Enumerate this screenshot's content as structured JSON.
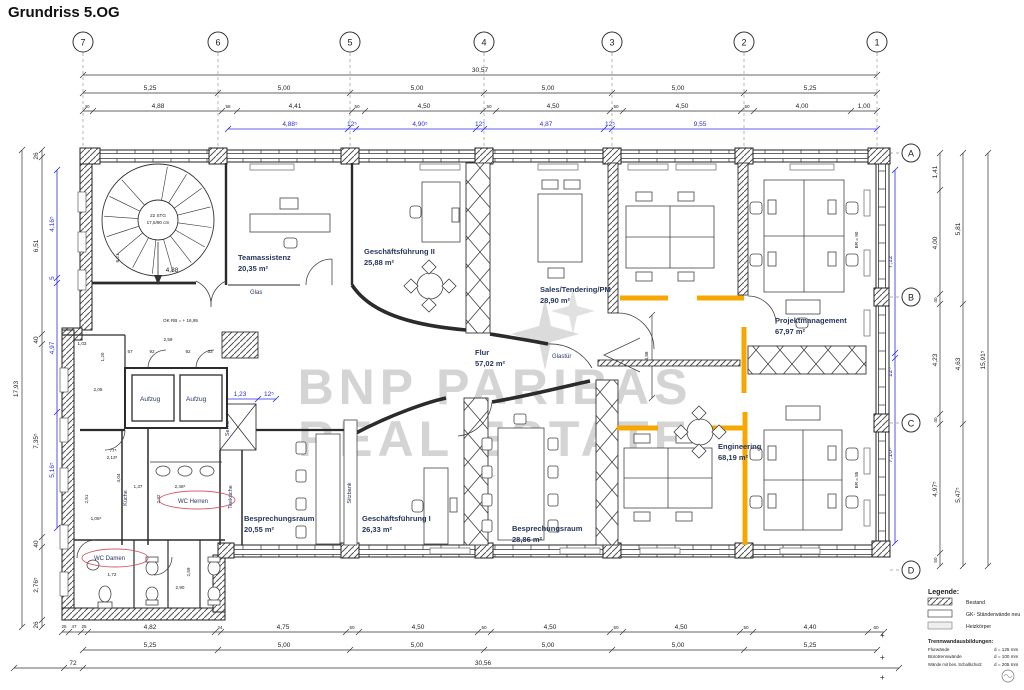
{
  "title": "Grundriss 5.OG",
  "grid": {
    "columns": [
      "7",
      "6",
      "5",
      "4",
      "3",
      "2",
      "1"
    ],
    "rows": [
      "A",
      "B",
      "C",
      "D"
    ]
  },
  "dims": {
    "top_total": "30,57",
    "top_bays": [
      "5,25",
      "5,00",
      "5,00",
      "5,00",
      "5,00",
      "5,25"
    ],
    "top_detail": [
      "40",
      "4,88",
      "58",
      "4,41",
      "50",
      "4,50",
      "50",
      "4,50",
      "50",
      "4,50",
      "50",
      "4,00",
      "1,00"
    ],
    "top_blue": [
      "4,88⁵",
      "12⁵",
      "4,90⁵",
      "12⁵",
      "4,87",
      "12⁵",
      "9,55"
    ],
    "left_total": "17,93",
    "left_chain": [
      "26",
      "6,51",
      "40",
      "7,35⁵",
      "40",
      "2,76⁵",
      "26"
    ],
    "left_blue": [
      "4,16⁵",
      "5",
      "4,97",
      "5,16⁵"
    ],
    "right_chain": [
      "1,41",
      "4,00",
      "40",
      "4,23",
      "40",
      "4,97⁵",
      "50"
    ],
    "right_chain2": [
      "5,81",
      "4,63",
      "5,47⁵"
    ],
    "right_total": "15,91⁵",
    "right_blue": [
      "7,12",
      "12⁵",
      "7,10⁵"
    ],
    "bottom_detail": [
      "25",
      "47",
      "25",
      "4,82",
      "24",
      "4,75",
      "50",
      "4,50",
      "50",
      "4,50",
      "50",
      "4,50",
      "50",
      "4,40",
      "60"
    ],
    "bottom_bays": [
      "5,25",
      "5,00",
      "5,00",
      "5,00",
      "5,00",
      "5,25"
    ],
    "bottom_left": "72",
    "bottom_total": "30,56",
    "interior": {
      "stair_width": "4,88",
      "stair_height": "8,21",
      "lobby_width": "2,59",
      "door1": "57",
      "door2": "92",
      "door3": "92",
      "door4": "33",
      "d103": "1,03",
      "d120": "1,20",
      "d205": "2,05",
      "blue_a": "1,23",
      "blue_b": "12⁵",
      "d388": "3,88",
      "d404": "4,04",
      "d137": "1,37",
      "d2485": "2,48⁵",
      "d232": "2,32",
      "d251": "2,51",
      "d775": "77⁵",
      "d2135": "2,13⁵",
      "d172": "1,72",
      "d1055": "1,05⁵",
      "d290": "2,90",
      "d259": "2,59"
    }
  },
  "rooms": {
    "teamassistenz": {
      "name": "Teamassistenz",
      "area": "20,35 m²"
    },
    "gf2": {
      "name": "Geschäftsführung II",
      "area": "25,88 m²"
    },
    "sales": {
      "name": "Sales/Tendering/PM",
      "area": "28,90 m²"
    },
    "projektmanagement": {
      "name": "Projektmanagement",
      "area": "67,97 m²"
    },
    "flur": {
      "name": "Flur",
      "area": "57,02 m²"
    },
    "besprechung1": {
      "name": "Besprechungsraum",
      "area": "20,55 m²"
    },
    "gf1": {
      "name": "Geschäftsführung I",
      "area": "26,33 m²"
    },
    "besprechung2": {
      "name": "Besprechungsraum",
      "area": "28,86 m²"
    },
    "engineering": {
      "name": "Engineering",
      "area": "68,19 m²"
    },
    "wc_herren": {
      "name": "WC Herren"
    },
    "wc_damen": {
      "name": "WC Damen"
    },
    "kueche": {
      "name": "Küche"
    },
    "teekueche": {
      "name": "Teeküche"
    },
    "sitzbank": {
      "name": "Sitzbank"
    },
    "server": {
      "name": "Server"
    },
    "aufzug": {
      "name": "Aufzug"
    }
  },
  "annotations": {
    "glas": "Glas",
    "glastuer": "Glastür",
    "ok_rb": "OK RB = + 16,95",
    "stair1": "22 STG",
    "stair2": "17,5/90 cm",
    "br1": "BR = 90",
    "br2": "BR = 85"
  },
  "watermark": {
    "line1": "BNP PARIBAS",
    "line2": "REAL ESTATE"
  },
  "legend": {
    "title": "Legende:",
    "items": [
      {
        "label": "Bestand"
      },
      {
        "label": "GK- Ständerwände neu"
      },
      {
        "label": "Heizkörper"
      }
    ],
    "sub_title": "Trennwandausbildungen:",
    "sub_items": [
      {
        "label": "Flurwände",
        "value": "d = 125 mm"
      },
      {
        "label": "Bürotrennwände",
        "value": "d = 100 mm"
      },
      {
        "label": "Wände mit bes. Schallschutz",
        "value": "d = 205 mm"
      }
    ]
  },
  "colors": {
    "highlight": "#F6A800",
    "dim_blue": "#2B2BE0",
    "watermark": "#C8C8C8"
  }
}
